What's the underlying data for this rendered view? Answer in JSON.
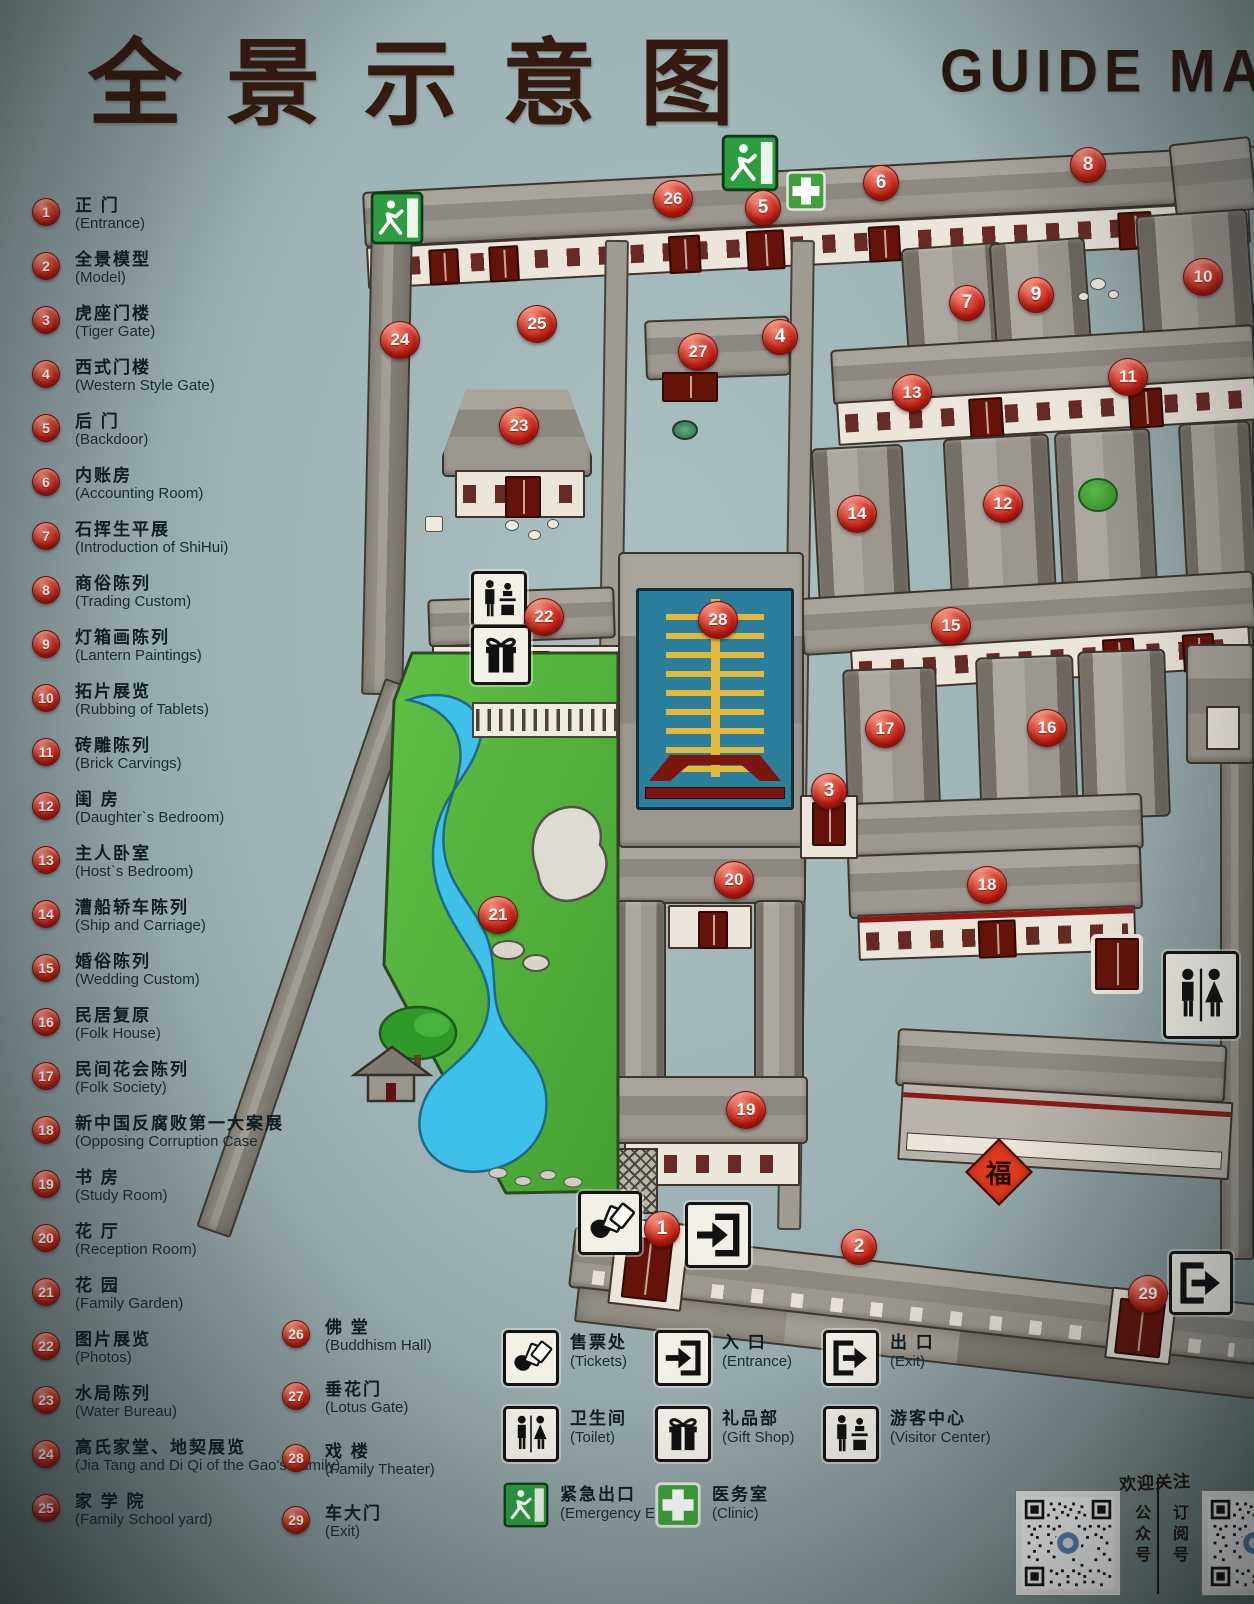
{
  "title": {
    "zh": "全景示意图",
    "en": "GUIDE MAP"
  },
  "legend": {
    "items": [
      {
        "num": "1",
        "zh": "正 门",
        "en": "(Entrance)"
      },
      {
        "num": "2",
        "zh": "全景模型",
        "en": "(Model)"
      },
      {
        "num": "3",
        "zh": "虎座门楼",
        "en": "(Tiger Gate)"
      },
      {
        "num": "4",
        "zh": "西式门楼",
        "en": "(Western Style Gate)"
      },
      {
        "num": "5",
        "zh": "后 门",
        "en": "(Backdoor)"
      },
      {
        "num": "6",
        "zh": "内账房",
        "en": "(Accounting Room)"
      },
      {
        "num": "7",
        "zh": "石挥生平展",
        "en": "(Introduction of ShiHui)"
      },
      {
        "num": "8",
        "zh": "商俗陈列",
        "en": "(Trading Custom)"
      },
      {
        "num": "9",
        "zh": "灯箱画陈列",
        "en": "(Lantern Paintings)"
      },
      {
        "num": "10",
        "zh": "拓片展览",
        "en": "(Rubbing of Tablets)"
      },
      {
        "num": "11",
        "zh": "砖雕陈列",
        "en": "(Brick Carvings)"
      },
      {
        "num": "12",
        "zh": "闺 房",
        "en": "(Daughter`s Bedroom)"
      },
      {
        "num": "13",
        "zh": "主人卧室",
        "en": "(Host`s Bedroom)"
      },
      {
        "num": "14",
        "zh": "漕船轿车陈列",
        "en": "(Ship and Carriage)"
      },
      {
        "num": "15",
        "zh": "婚俗陈列",
        "en": "(Wedding Custom)"
      },
      {
        "num": "16",
        "zh": "民居复原",
        "en": "(Folk House)"
      },
      {
        "num": "17",
        "zh": "民间花会陈列",
        "en": "(Folk Society)"
      },
      {
        "num": "18",
        "zh": "新中国反腐败第一大案展",
        "en": "(Opposing Corruption Case"
      },
      {
        "num": "19",
        "zh": "书 房",
        "en": "(Study Room)"
      },
      {
        "num": "20",
        "zh": "花 厅",
        "en": "(Reception Room)"
      },
      {
        "num": "21",
        "zh": "花 园",
        "en": "(Family Garden)"
      },
      {
        "num": "22",
        "zh": "图片展览",
        "en": "(Photos)"
      },
      {
        "num": "23",
        "zh": "水局陈列",
        "en": "(Water Bureau)"
      },
      {
        "num": "24",
        "zh": "高氏家堂、地契展览",
        "en": "(Jia Tang and Di Qi of the Gao's Family)"
      },
      {
        "num": "25",
        "zh": "家 学 院",
        "en": "(Family School yard)"
      },
      {
        "num": "26",
        "zh": "佛 堂",
        "en": "(Buddhism Hall)"
      },
      {
        "num": "27",
        "zh": "垂花门",
        "en": "(Lotus Gate)"
      },
      {
        "num": "28",
        "zh": "戏 楼",
        "en": "(Family Theater)"
      },
      {
        "num": "29",
        "zh": "车大门",
        "en": "(Exit)"
      }
    ]
  },
  "facilities": [
    {
      "icon": "tickets",
      "zh": "售票处",
      "en": "(Tickets)"
    },
    {
      "icon": "entrance",
      "zh": "入 口",
      "en": "(Entrance)"
    },
    {
      "icon": "exit",
      "zh": "出 口",
      "en": "(Exit)"
    },
    {
      "icon": "toilet",
      "zh": "卫生间",
      "en": "(Toilet)"
    },
    {
      "icon": "gift-shop",
      "zh": "礼品部",
      "en": "(Gift Shop)"
    },
    {
      "icon": "visitor-center",
      "zh": "游客中心",
      "en": "(Visitor Center)"
    },
    {
      "icon": "emergency-exit",
      "zh": "紧急出口",
      "en": "(Emergency Exit)"
    },
    {
      "icon": "clinic",
      "zh": "医务室",
      "en": "(Clinic)"
    }
  ],
  "qr": {
    "caption": "欢迎关注",
    "left_label": "公众号",
    "right_label": "订阅号"
  },
  "map": {
    "fu_label": "福",
    "markers": [
      {
        "num": "1",
        "x": 661,
        "y": 1228
      },
      {
        "num": "2",
        "x": 858,
        "y": 1246
      },
      {
        "num": "3",
        "x": 828,
        "y": 790
      },
      {
        "num": "4",
        "x": 779,
        "y": 336
      },
      {
        "num": "5",
        "x": 762,
        "y": 207
      },
      {
        "num": "6",
        "x": 880,
        "y": 182
      },
      {
        "num": "7",
        "x": 966,
        "y": 302
      },
      {
        "num": "8",
        "x": 1087,
        "y": 164
      },
      {
        "num": "9",
        "x": 1035,
        "y": 294
      },
      {
        "num": "10",
        "x": 1202,
        "y": 277
      },
      {
        "num": "11",
        "x": 1127,
        "y": 377
      },
      {
        "num": "12",
        "x": 1002,
        "y": 504
      },
      {
        "num": "13",
        "x": 911,
        "y": 393
      },
      {
        "num": "14",
        "x": 856,
        "y": 514
      },
      {
        "num": "15",
        "x": 950,
        "y": 626
      },
      {
        "num": "16",
        "x": 1046,
        "y": 728
      },
      {
        "num": "17",
        "x": 884,
        "y": 729
      },
      {
        "num": "18",
        "x": 986,
        "y": 885
      },
      {
        "num": "19",
        "x": 745,
        "y": 1110
      },
      {
        "num": "20",
        "x": 733,
        "y": 880
      },
      {
        "num": "21",
        "x": 497,
        "y": 915
      },
      {
        "num": "22",
        "x": 543,
        "y": 617
      },
      {
        "num": "23",
        "x": 518,
        "y": 426
      },
      {
        "num": "24",
        "x": 399,
        "y": 340
      },
      {
        "num": "25",
        "x": 536,
        "y": 324
      },
      {
        "num": "26",
        "x": 672,
        "y": 199
      },
      {
        "num": "27",
        "x": 697,
        "y": 352
      },
      {
        "num": "28",
        "x": 717,
        "y": 620
      },
      {
        "num": "29",
        "x": 1147,
        "y": 1294
      }
    ],
    "icons": [
      {
        "type": "emergency-exit",
        "x": 370,
        "y": 191,
        "w": 54,
        "h": 54
      },
      {
        "type": "emergency-exit",
        "x": 721,
        "y": 134,
        "w": 58,
        "h": 58
      },
      {
        "type": "clinic",
        "x": 786,
        "y": 171,
        "w": 40,
        "h": 40
      },
      {
        "type": "toilet",
        "x": 1163,
        "y": 951,
        "w": 66,
        "h": 78
      },
      {
        "type": "visitor-center",
        "x": 471,
        "y": 571,
        "w": 46,
        "h": 46
      },
      {
        "type": "gift-shop",
        "x": 471,
        "y": 625,
        "w": 50,
        "h": 50
      },
      {
        "type": "tickets",
        "x": 578,
        "y": 1191,
        "w": 54,
        "h": 54
      },
      {
        "type": "entrance",
        "x": 685,
        "y": 1202,
        "w": 56,
        "h": 56
      },
      {
        "type": "exit",
        "x": 1169,
        "y": 1251,
        "w": 54,
        "h": 54
      }
    ]
  },
  "colors": {
    "background": "#9eb3b5",
    "accent_red": "#c42417",
    "building_gray": "#918c84",
    "garden_green": "#54b53c",
    "pond_blue": "#3fc0e8",
    "theater_teal": "#2c7e9d",
    "theater_gold": "#e2b93c",
    "sign_green": "#2e9c41",
    "title_brown": "#351a10"
  }
}
